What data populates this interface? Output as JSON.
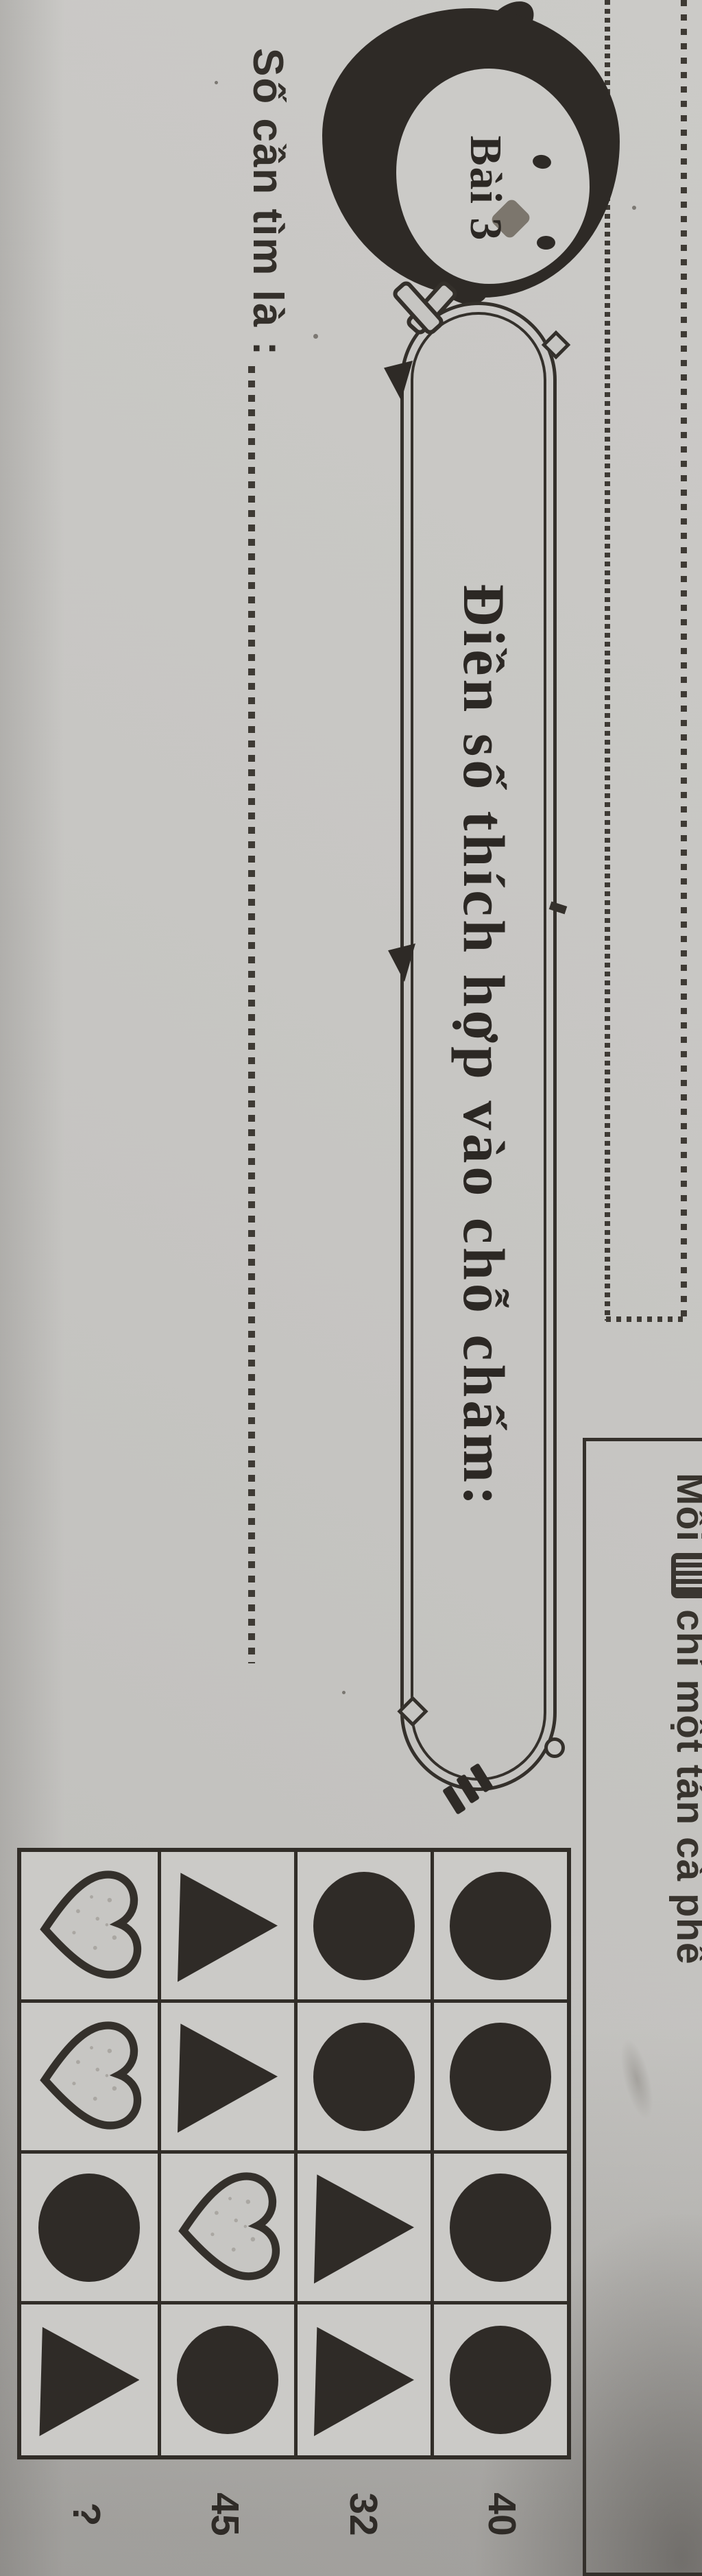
{
  "header": {
    "prefix": "Mỗi",
    "icon": "stamp-icon",
    "suffix": "chỉ một tán cà phê"
  },
  "badge": {
    "label": "Bài 3"
  },
  "banner": {
    "title": "Điền số thích hợp vào chỗ chấm:"
  },
  "answer": {
    "label": "Số cần tìm là :"
  },
  "grid": {
    "rows": [
      [
        "circle",
        "circle",
        "circle",
        "circle"
      ],
      [
        "circle",
        "circle",
        "triangle",
        "triangle"
      ],
      [
        "triangle",
        "triangle",
        "heart",
        "circle"
      ],
      [
        "heart",
        "heart",
        "circle",
        "triangle"
      ]
    ],
    "row_values": [
      "40",
      "32",
      "45",
      "?"
    ]
  },
  "colors": {
    "paper": "#c6c5c2",
    "ink": "#2e2a26",
    "line": "#34302b",
    "beak": "#7c766d",
    "heart_fill": "#c7c6c3"
  }
}
